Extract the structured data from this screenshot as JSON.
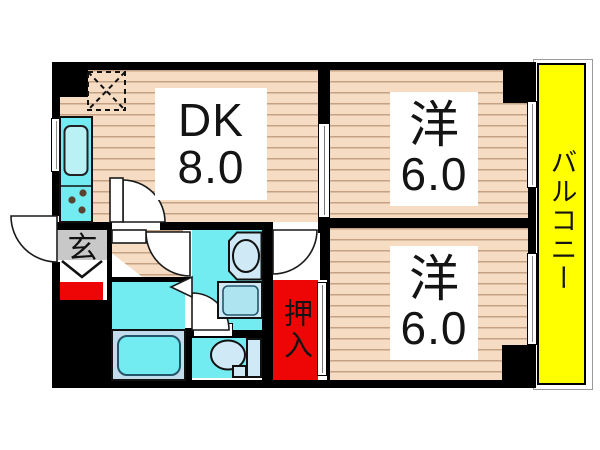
{
  "rooms": {
    "dining_kitchen": {
      "label": "DK",
      "size": "8.0"
    },
    "bedroom_top": {
      "label": "洋",
      "size": "6.0"
    },
    "bedroom_bottom": {
      "label": "洋",
      "size": "6.0"
    },
    "balcony": {
      "label": "バルコニー"
    },
    "entrance": {
      "label": "玄"
    },
    "closet": {
      "label": "押入"
    }
  },
  "fixtures": {
    "refrigerator_space": "dashed-box-with-x",
    "kitchen_sink": "rounded-rect",
    "stove_burners": "three-dots",
    "bathtub": "rounded-rect-in-surround",
    "washbasin": "oval-in-cabinet",
    "washing_machine_pan": "rounded-square",
    "toilet": "bowl-and-tank"
  },
  "colors": {
    "wall": "#000000",
    "flooring": "#f5dcc3",
    "flooring_line": "#a97c54",
    "wet_area": "#72ecf0",
    "fixture_light": "#cfe9f6",
    "tub_surround": "#c3dcec",
    "closet_red": "#ee0606",
    "balcony_yellow": "#ffff00",
    "entrance_gray": "#c8c8c8"
  }
}
